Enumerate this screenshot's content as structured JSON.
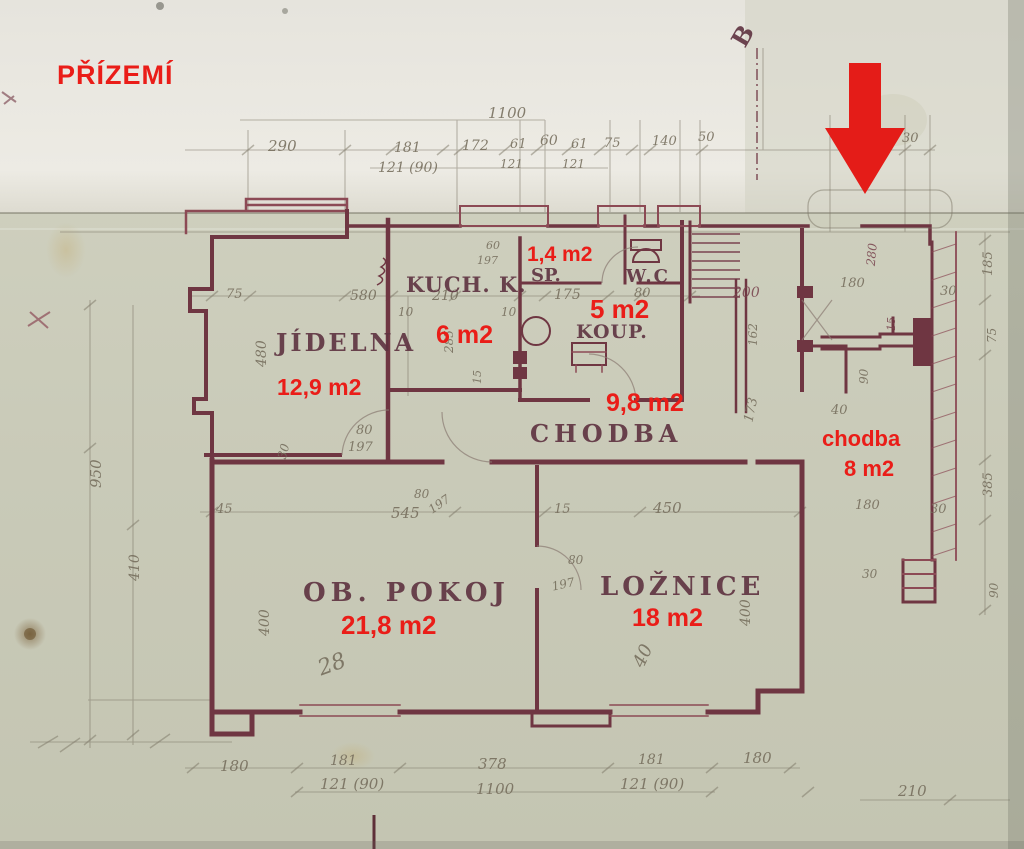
{
  "document": {
    "floor_title": "PŘÍZEMÍ",
    "section_mark": "B"
  },
  "colors": {
    "annotation_red": "#ea1d18",
    "wall_ink": "#6f3642",
    "pencil": "#756d5c",
    "paper": "#cbccba",
    "paper_top": "#eae8e1"
  },
  "rooms": {
    "jidelna": {
      "name": "JÍDELNA",
      "area": "12,9 m2"
    },
    "kuchyn": {
      "name": "KUCH. K.",
      "area": "6 m2"
    },
    "spiz": {
      "name": "SP.",
      "area": "1,4 m2"
    },
    "wc": {
      "name": "W.C"
    },
    "koupelna": {
      "name": "KOUP.",
      "area": "5 m2"
    },
    "chodba": {
      "name": "CHODBA",
      "area": "9,8 m2"
    },
    "chodba_vstup": {
      "name": "chodba",
      "area": "8 m2"
    },
    "obyvaci_pokoj": {
      "name": "OB. POKOJ",
      "area": "21,8 m2"
    },
    "loznice": {
      "name": "LOŽNICE",
      "area": "18 m2"
    }
  },
  "dims": [
    "1100",
    "290",
    "181",
    "121 (90)",
    "172",
    "61",
    "121",
    "60",
    "61",
    "121",
    "75",
    "140",
    "50",
    "30",
    "580",
    "75",
    "480",
    "950",
    "410",
    "210",
    "10",
    "285",
    "10",
    "15",
    "60",
    "197",
    "175",
    "80",
    "200",
    "162",
    "173",
    "180",
    "280",
    "30",
    "185",
    "15",
    "75",
    "90",
    "40",
    "80",
    "197",
    "45",
    "545",
    "80",
    "197",
    "15",
    "450",
    "80",
    "197",
    "400",
    "28",
    "40",
    "400",
    "385",
    "180",
    "30",
    "90",
    "30",
    "180",
    "181",
    "121 (90)",
    "378",
    "1100",
    "181",
    "121 (90)",
    "180",
    "210",
    "30"
  ]
}
